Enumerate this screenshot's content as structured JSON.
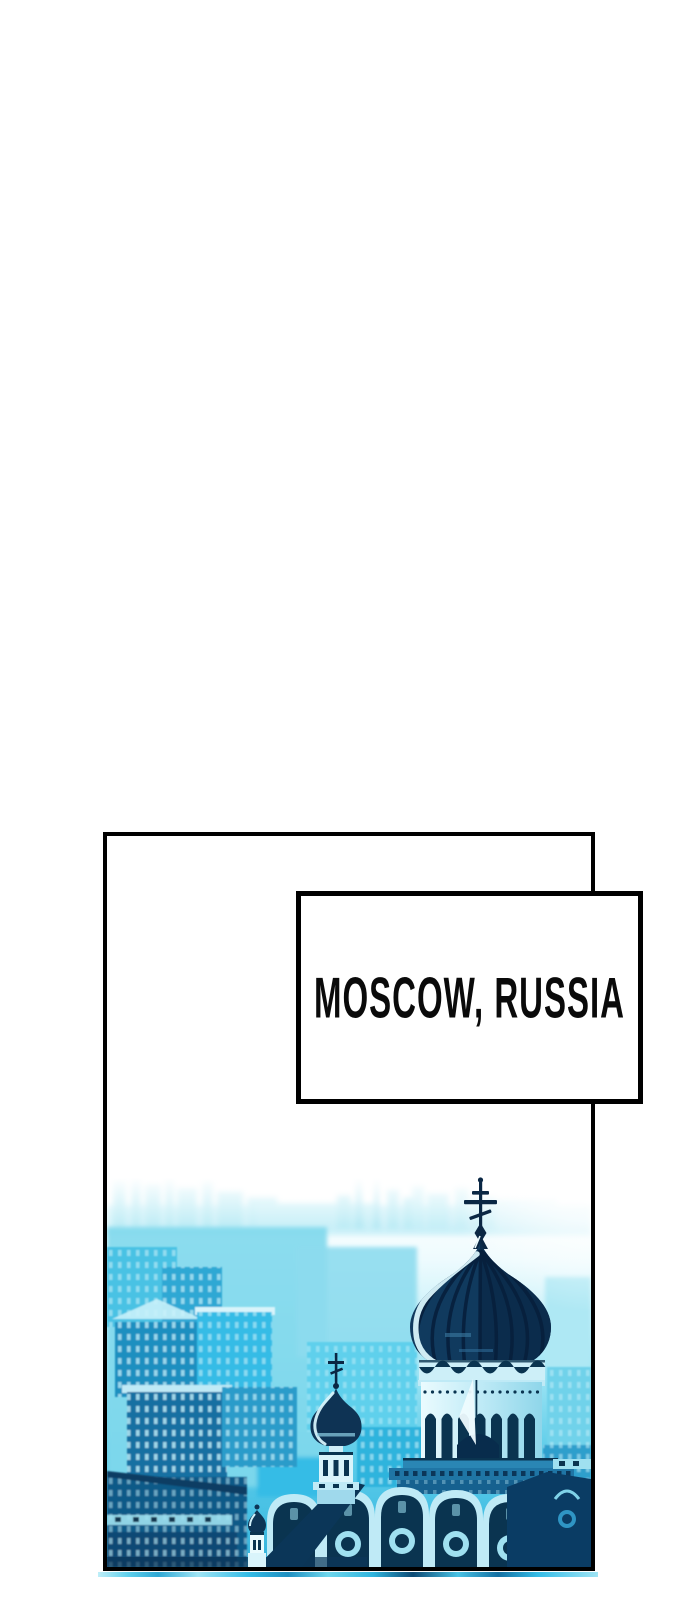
{
  "page": {
    "background_color": "#ffffff"
  },
  "panel": {
    "border_color": "#000000",
    "background_color": "#ffffff",
    "caption": {
      "text": "MOSCOW, RUSSIA",
      "text_color": "#0a0a0a",
      "background_color": "#ffffff",
      "border_color": "#000000"
    },
    "illustration": {
      "alt": "Cyan duotone aerial view of Moscow: hazy skyline fading from white, city blocks, and the Cathedral of Christ the Saviour with a dark onion dome, Orthodox cross and kokoshnik arches",
      "palette": {
        "white_haze": "#ffffff",
        "pale_cyan": "#d9f4fb",
        "light_cyan": "#9fe4f4",
        "sky_cyan": "#5fd0ec",
        "bright_cyan": "#2fb4dd",
        "mid_blue": "#1f8fc0",
        "deep_blue": "#1470a2",
        "navy": "#0a3c64",
        "dome_navy": "#0d2f4f"
      }
    }
  },
  "next_panel_peek": {
    "color": "#2fb4dd"
  }
}
